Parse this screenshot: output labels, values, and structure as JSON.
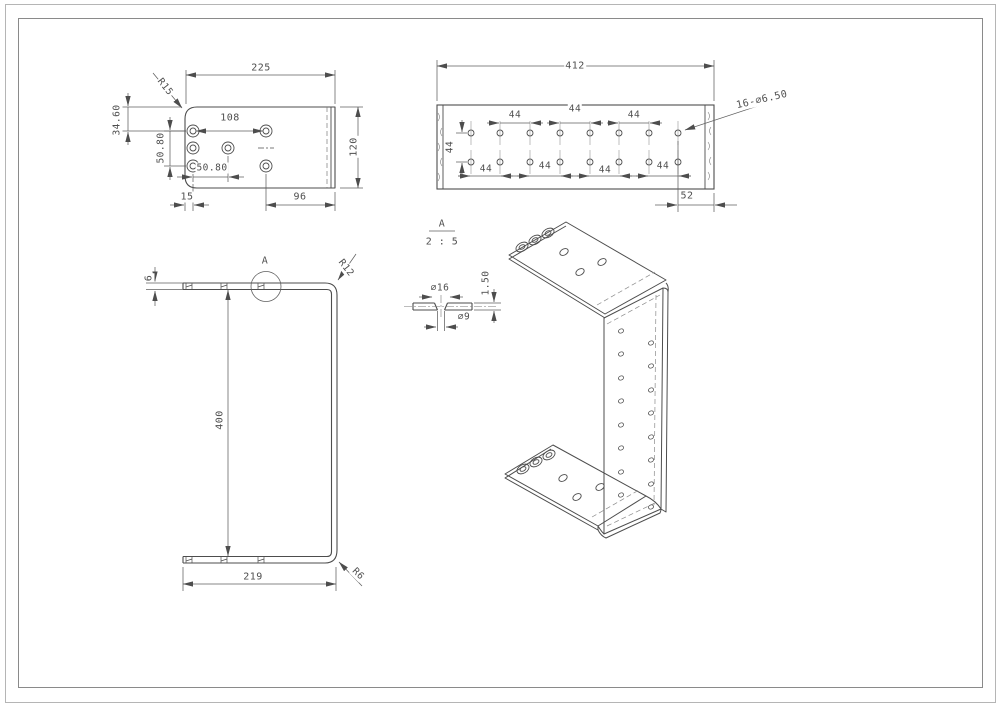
{
  "sheet": {
    "background": "#ffffff",
    "line_color": "#4d4d4d",
    "dim_color": "#5f5f5f",
    "text_color": "#4e4e4e"
  },
  "flange_view": {
    "width": "225",
    "height": "120",
    "corner_radius": "R15",
    "hole_pitch_x": "108",
    "top_offset": "34.60",
    "hole_pitch_y": "50.80",
    "hole_pitch_x2": "50.80",
    "edge_margin": "15",
    "right_margin": "96"
  },
  "web_view": {
    "length": "412",
    "row_gap": "44",
    "end_margin": "52",
    "holes_callout": "16-⌀6.50",
    "row1_pitches": [
      "44",
      "44",
      "44"
    ],
    "row2_pitches": [
      "44",
      "44",
      "44",
      "44"
    ]
  },
  "profile_view": {
    "thickness": "6",
    "detail_marker": "A",
    "top_bend_radius": "R12",
    "height": "400",
    "base_length": "219",
    "bottom_bend_radius": "R6"
  },
  "detail_view": {
    "label": "A",
    "scale": "2 : 5",
    "counterbore_dia": "⌀16",
    "hole_dia": "⌀9",
    "depth": "1.50"
  }
}
